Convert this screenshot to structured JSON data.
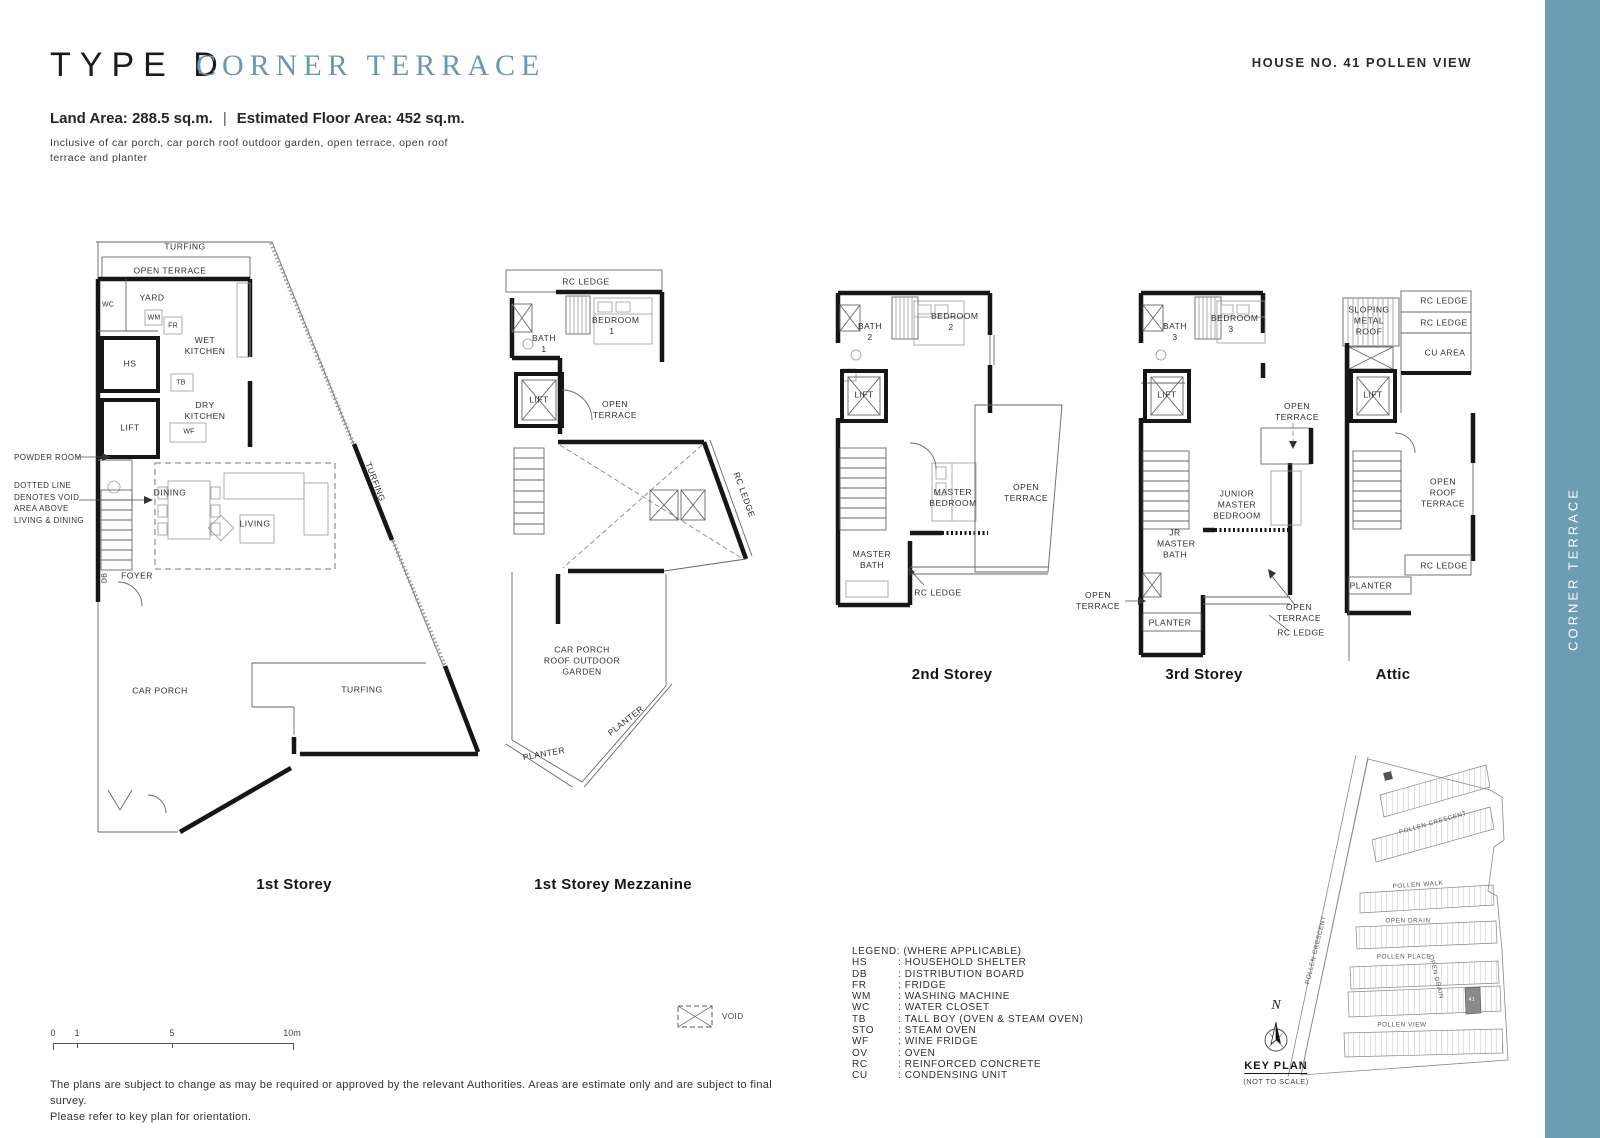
{
  "colors": {
    "accent": "#6899AD",
    "sidebar": "#6D9DB3"
  },
  "header": {
    "type_label": "TYPE D",
    "subtype_label": "CORNER TERRACE",
    "house_no": "HOUSE NO. 41 POLLEN VIEW",
    "land_area": "Land Area: 288.5 sq.m.",
    "separator": "|",
    "floor_area": "Estimated Floor Area: 452 sq.m.",
    "inclusive_note": "Inclusive of car porch, car porch roof outdoor garden, open terrace, open roof terrace and planter"
  },
  "sidebar": {
    "label": "CORNER TERRACE"
  },
  "plans": {
    "storey1": {
      "caption": "1st Storey",
      "labels": {
        "turfing_top": "TURFING",
        "open_terrace": "OPEN TERRACE",
        "wc": "WC",
        "yard": "YARD",
        "wm": "WM",
        "fr": "FR",
        "hs": "HS",
        "wet_kitchen": "WET KITCHEN",
        "lift": "LIFT",
        "tb": "TB",
        "dry_kitchen": "DRY KITCHEN",
        "wf": "WF",
        "powder_room": "POWDER ROOM",
        "void_note": "DOTTED LINE DENOTES VOID AREA ABOVE LIVING & DINING",
        "dining": "DINING",
        "living": "LIVING",
        "foyer": "FOYER",
        "db": "DB",
        "car_porch": "CAR PORCH",
        "turfing_bottom": "TURFING",
        "turfing_side": "TURFING"
      }
    },
    "mezzanine": {
      "caption": "1st Storey Mezzanine",
      "labels": {
        "rc_ledge_top": "RC LEDGE",
        "bath1": "BATH 1",
        "bedroom1": "BEDROOM 1",
        "lift": "LIFT",
        "open_terrace": "OPEN TERRACE",
        "rc_ledge_side": "RC LEDGE",
        "garden": "CAR PORCH ROOF OUTDOOR GARDEN",
        "planter_a": "PLANTER",
        "planter_b": "PLANTER"
      }
    },
    "storey2": {
      "caption": "2nd Storey",
      "labels": {
        "bath2": "BATH 2",
        "bedroom2": "BEDROOM 2",
        "lift": "LIFT",
        "master_bedroom": "MASTER BEDROOM",
        "open_terrace": "OPEN TERRACE",
        "master_bath": "MASTER BATH",
        "rc_ledge": "RC LEDGE"
      }
    },
    "storey3": {
      "caption": "3rd Storey",
      "labels": {
        "bath3": "BATH 3",
        "bedroom3": "BEDROOM 3",
        "lift": "LIFT",
        "open_terrace_upper": "OPEN TERRACE",
        "junior_master_bedroom": "JUNIOR MASTER BEDROOM",
        "jr_master_bath": "JR MASTER BATH",
        "open_terrace_left": "OPEN TERRACE",
        "planter": "PLANTER",
        "open_terrace_right": "OPEN TERRACE",
        "rc_ledge": "RC LEDGE"
      }
    },
    "attic": {
      "caption": "Attic",
      "labels": {
        "sloping_roof": "SLOPING METAL ROOF",
        "rc_ledge_1": "RC LEDGE",
        "rc_ledge_2": "RC LEDGE",
        "cu_area": "CU AREA",
        "lift": "LIFT",
        "open_roof_terrace": "OPEN ROOF TERRACE",
        "rc_ledge_3": "RC LEDGE",
        "planter": "PLANTER"
      }
    }
  },
  "legend": {
    "title": "LEGEND: (WHERE APPLICABLE)",
    "items": [
      {
        "abbr": "HS",
        "desc": ": HOUSEHOLD SHELTER"
      },
      {
        "abbr": "DB",
        "desc": ": DISTRIBUTION BOARD"
      },
      {
        "abbr": "FR",
        "desc": ": FRIDGE"
      },
      {
        "abbr": "WM",
        "desc": ": WASHING MACHINE"
      },
      {
        "abbr": "WC",
        "desc": ": WATER CLOSET"
      },
      {
        "abbr": "TB",
        "desc": ": TALL BOY (OVEN & STEAM OVEN)"
      },
      {
        "abbr": "STO",
        "desc": ": STEAM OVEN"
      },
      {
        "abbr": "WF",
        "desc": ": WINE FRIDGE"
      },
      {
        "abbr": "OV",
        "desc": ": OVEN"
      },
      {
        "abbr": "RC",
        "desc": ": REINFORCED CONCRETE"
      },
      {
        "abbr": "CU",
        "desc": ": CONDENSING UNIT"
      }
    ]
  },
  "scalebar": {
    "tick0": "0",
    "tick1": "1",
    "tick5": "5",
    "tick10": "10m"
  },
  "void_symbol": {
    "label": "VOID"
  },
  "disclaimer": {
    "line1": "The plans are subject to change as may be required or approved by the relevant Authorities. Areas are estimate only and are subject to final survey.",
    "line2": "Please refer to key plan for orientation."
  },
  "keyplan": {
    "north": "N",
    "title": "KEY PLAN",
    "subtitle": "(NOT TO SCALE)",
    "lot_no": "41",
    "streets": {
      "pollen_crescent_top": "POLLEN CRESCENT",
      "pollen_walk": "POLLEN WALK",
      "open_drain": "OPEN DRAIN",
      "pollen_place": "POLLEN PLACE",
      "pollen_view": "POLLEN VIEW",
      "pollen_crescent_left": "POLLEN CRESCENT",
      "open_drain_right": "OPEN DRAIN"
    }
  }
}
